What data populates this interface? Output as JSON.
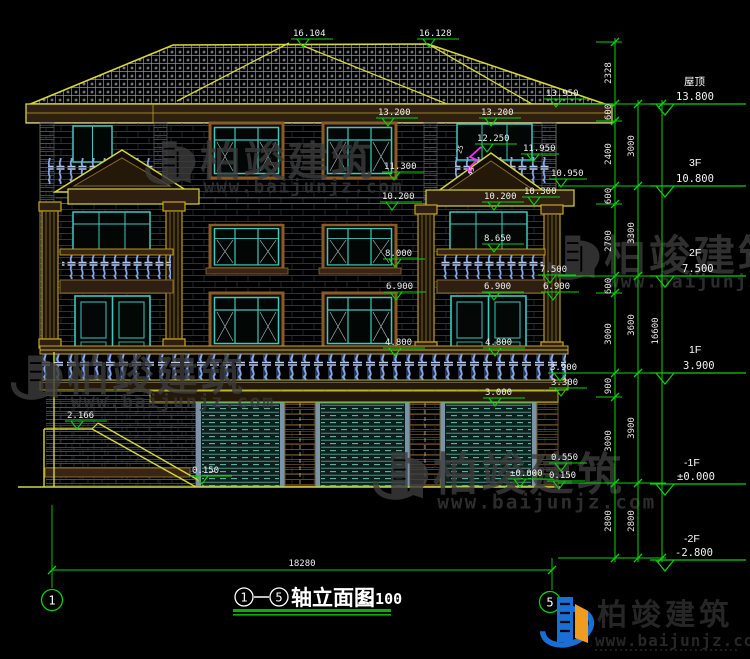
{
  "colors": {
    "background": "#000000",
    "dim_green": "#0ad20a",
    "outline_yellow": "#d6d63c",
    "window_teal": "#3fc8bc",
    "baluster_blue": "#86a8e8",
    "text_white": "#f0f0f0",
    "watermark_gray": "#3d3d3d",
    "logo_blue": "#1a6fd4",
    "logo_orange": "#f09c1e",
    "annotation_magenta": "#ff2ef0"
  },
  "markers": [
    "16.104",
    "16.128",
    "13.950",
    "13.200",
    "13.200",
    "12.250",
    "11.950",
    "11.300",
    "10.950",
    "10.200",
    "10.200",
    "10.300",
    "8.650",
    "8.000",
    "7.500",
    "6.900",
    "6.900",
    "6.900",
    "4.800",
    "4.800",
    "3.900",
    "3.300",
    "3.000",
    "2.166",
    "0.550",
    "±0.000",
    "0.150",
    "0.150"
  ],
  "floors": [
    {
      "label": "屋顶",
      "value": "13.800"
    },
    {
      "label": "3F",
      "value": "10.800"
    },
    {
      "label": "2F",
      "value": "7.500"
    },
    {
      "label": "1F",
      "value": "3.900"
    },
    {
      "label": "-1F",
      "value": "±0.000"
    },
    {
      "label": "-2F",
      "value": "-2.800"
    }
  ],
  "chainA": [
    "2328",
    "600",
    "2400",
    "600",
    "2700",
    "600",
    "3000",
    "900",
    "3000",
    "2800"
  ],
  "chainB": [
    "3000",
    "3300",
    "3600",
    "3900",
    "2800"
  ],
  "chainC": [
    "16600"
  ],
  "bottom_dim": "18280",
  "axes": {
    "left": "1",
    "right": "5"
  },
  "title": {
    "axis_from": "1",
    "axis_to": "5",
    "name": "轴立面图",
    "scale": "1:100"
  },
  "watermark": {
    "brand": "柏竣建筑",
    "url": "www.baijunjz.com"
  },
  "logo": {
    "brand": "柏竣建筑",
    "url": "www.baijunjz.com"
  },
  "notes": {
    "a": "25",
    "b": "45"
  }
}
